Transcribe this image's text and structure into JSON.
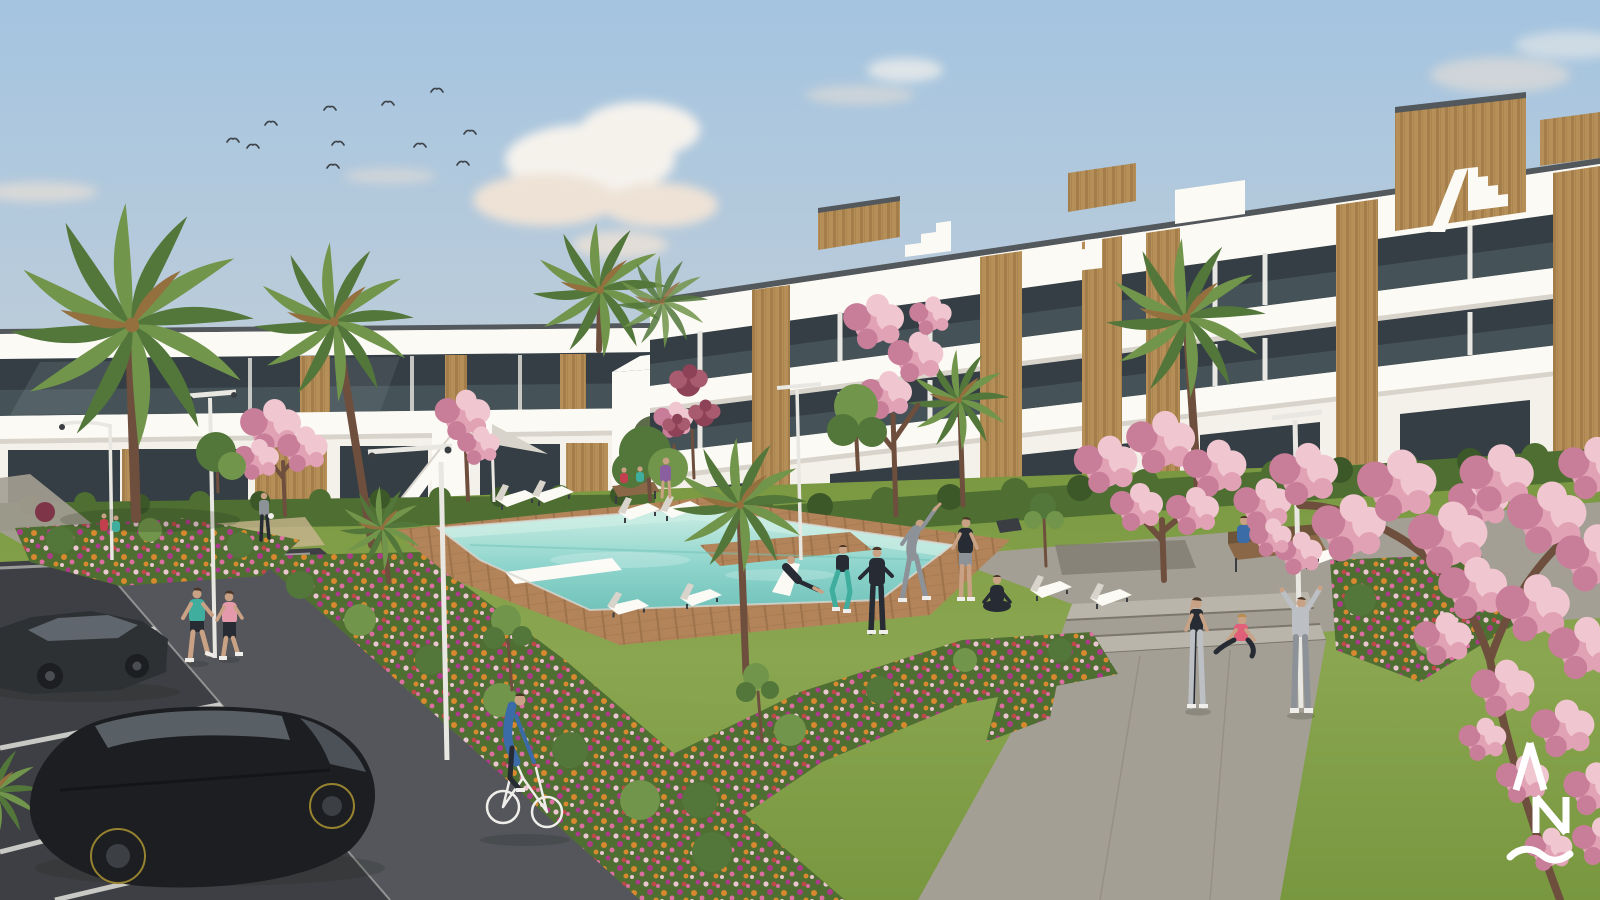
{
  "image": {
    "alt": "Architectural render of a white modern apartment complex with wood-clad accents around a landscaped courtyard: turquoise pool with wooden deck and sun loungers, lawns with people exercising, flower beds, palm and pink blossom trees, joggers, a cyclist, walkways with steps, and a parking lot with two dark cars in the foreground; flock of birds in a soft blue sky"
  },
  "watermark": {
    "letters": "AN",
    "style": "white monogram: caret A over N with wave below"
  },
  "scene": {
    "elements": [
      "sky",
      "clouds",
      "bird-flock",
      "apartment-building-left",
      "apartment-building-right",
      "rooftop-wood-volumes",
      "hedges",
      "lawn",
      "swimming-pool",
      "pool-deck",
      "sun-loungers",
      "parasol",
      "street-lamps",
      "benches",
      "flower-beds",
      "palm-trees",
      "blossom-trees",
      "concrete-walkway",
      "steps",
      "dark-footpath",
      "parking-lot",
      "sedan-car",
      "hatchback-car",
      "joggers",
      "cyclist",
      "exercise-group",
      "yoga-person",
      "people-on-bench",
      "watermark-logo"
    ],
    "birds_count": 11,
    "cars_count": 2
  },
  "colors": {
    "sky_top": "#a4c4e0",
    "sky_mid": "#c3cfd8",
    "sky_horizon": "#e8d9c8",
    "cloud_white": "#f5f2ec",
    "cloud_warm": "#eee2d6",
    "bird": "#3e444a",
    "building_white": "#f4f1ea",
    "building_bright": "#fcfaf5",
    "building_shade": "#d9d4cb",
    "roof_trim": "#53585c",
    "glass_dark": "#343e44",
    "glass_mid": "#5c6a70",
    "glass_light": "#9aabb1",
    "wood_light": "#b68e57",
    "wood_dark": "#94703f",
    "hedge_dark": "#3c5829",
    "hedge_mid": "#4e6e32",
    "tree_green": "#53773a",
    "tree_green_light": "#71954a",
    "lawn_light": "#8aa650",
    "lawn_mid": "#78973f",
    "lawn_dark": "#5f7d33",
    "blossom_light": "#f0c6d0",
    "blossom_mid": "#e2a2b6",
    "blossom_dark": "#c87e98",
    "blossom_deep": "#8e4257",
    "branch_brown": "#6e4f3e",
    "flower_orange": "#d8892e",
    "flower_pink": "#dc6f9f",
    "flower_magenta": "#ae3a8a",
    "flower_red": "#bf4848",
    "flower_cream": "#eac6d1",
    "deck_wood": "#b3845a",
    "deck_wood_dark": "#9e734b",
    "water_far": "#cdeee4",
    "water_mid": "#8fd5cd",
    "water_near": "#72c3ba",
    "concrete": "#a49f94",
    "concrete_light": "#bab5aa",
    "concrete_dark": "#7c776d",
    "path_dark": "#54565b",
    "asphalt": "#3d3f44",
    "line_white": "#d8d7d2",
    "lamp_white": "#e9e7e1",
    "metal_dark": "#3a3e42",
    "car_black": "#1c1e21",
    "car_body": "#2e3134",
    "car_glass": "#5f666d",
    "rim_amber": "#96822f",
    "skin": "#c9a184",
    "hair_dark": "#4a3628",
    "outfit_teal": "#3fae9f",
    "outfit_pink": "#e59aab",
    "outfit_blue": "#3c6ca8",
    "outfit_navy": "#262b34",
    "outfit_gray": "#8d9298",
    "outfit_lightgray": "#bcc0c5",
    "outfit_coral": "#e0607a",
    "outfit_red": "#c23f4e",
    "outfit_purple": "#8a5fa0",
    "outfit_white": "#efeeea",
    "bench_wood": "#8a6847",
    "logo_white": "#ffffff",
    "shadow": "#1b2414"
  }
}
